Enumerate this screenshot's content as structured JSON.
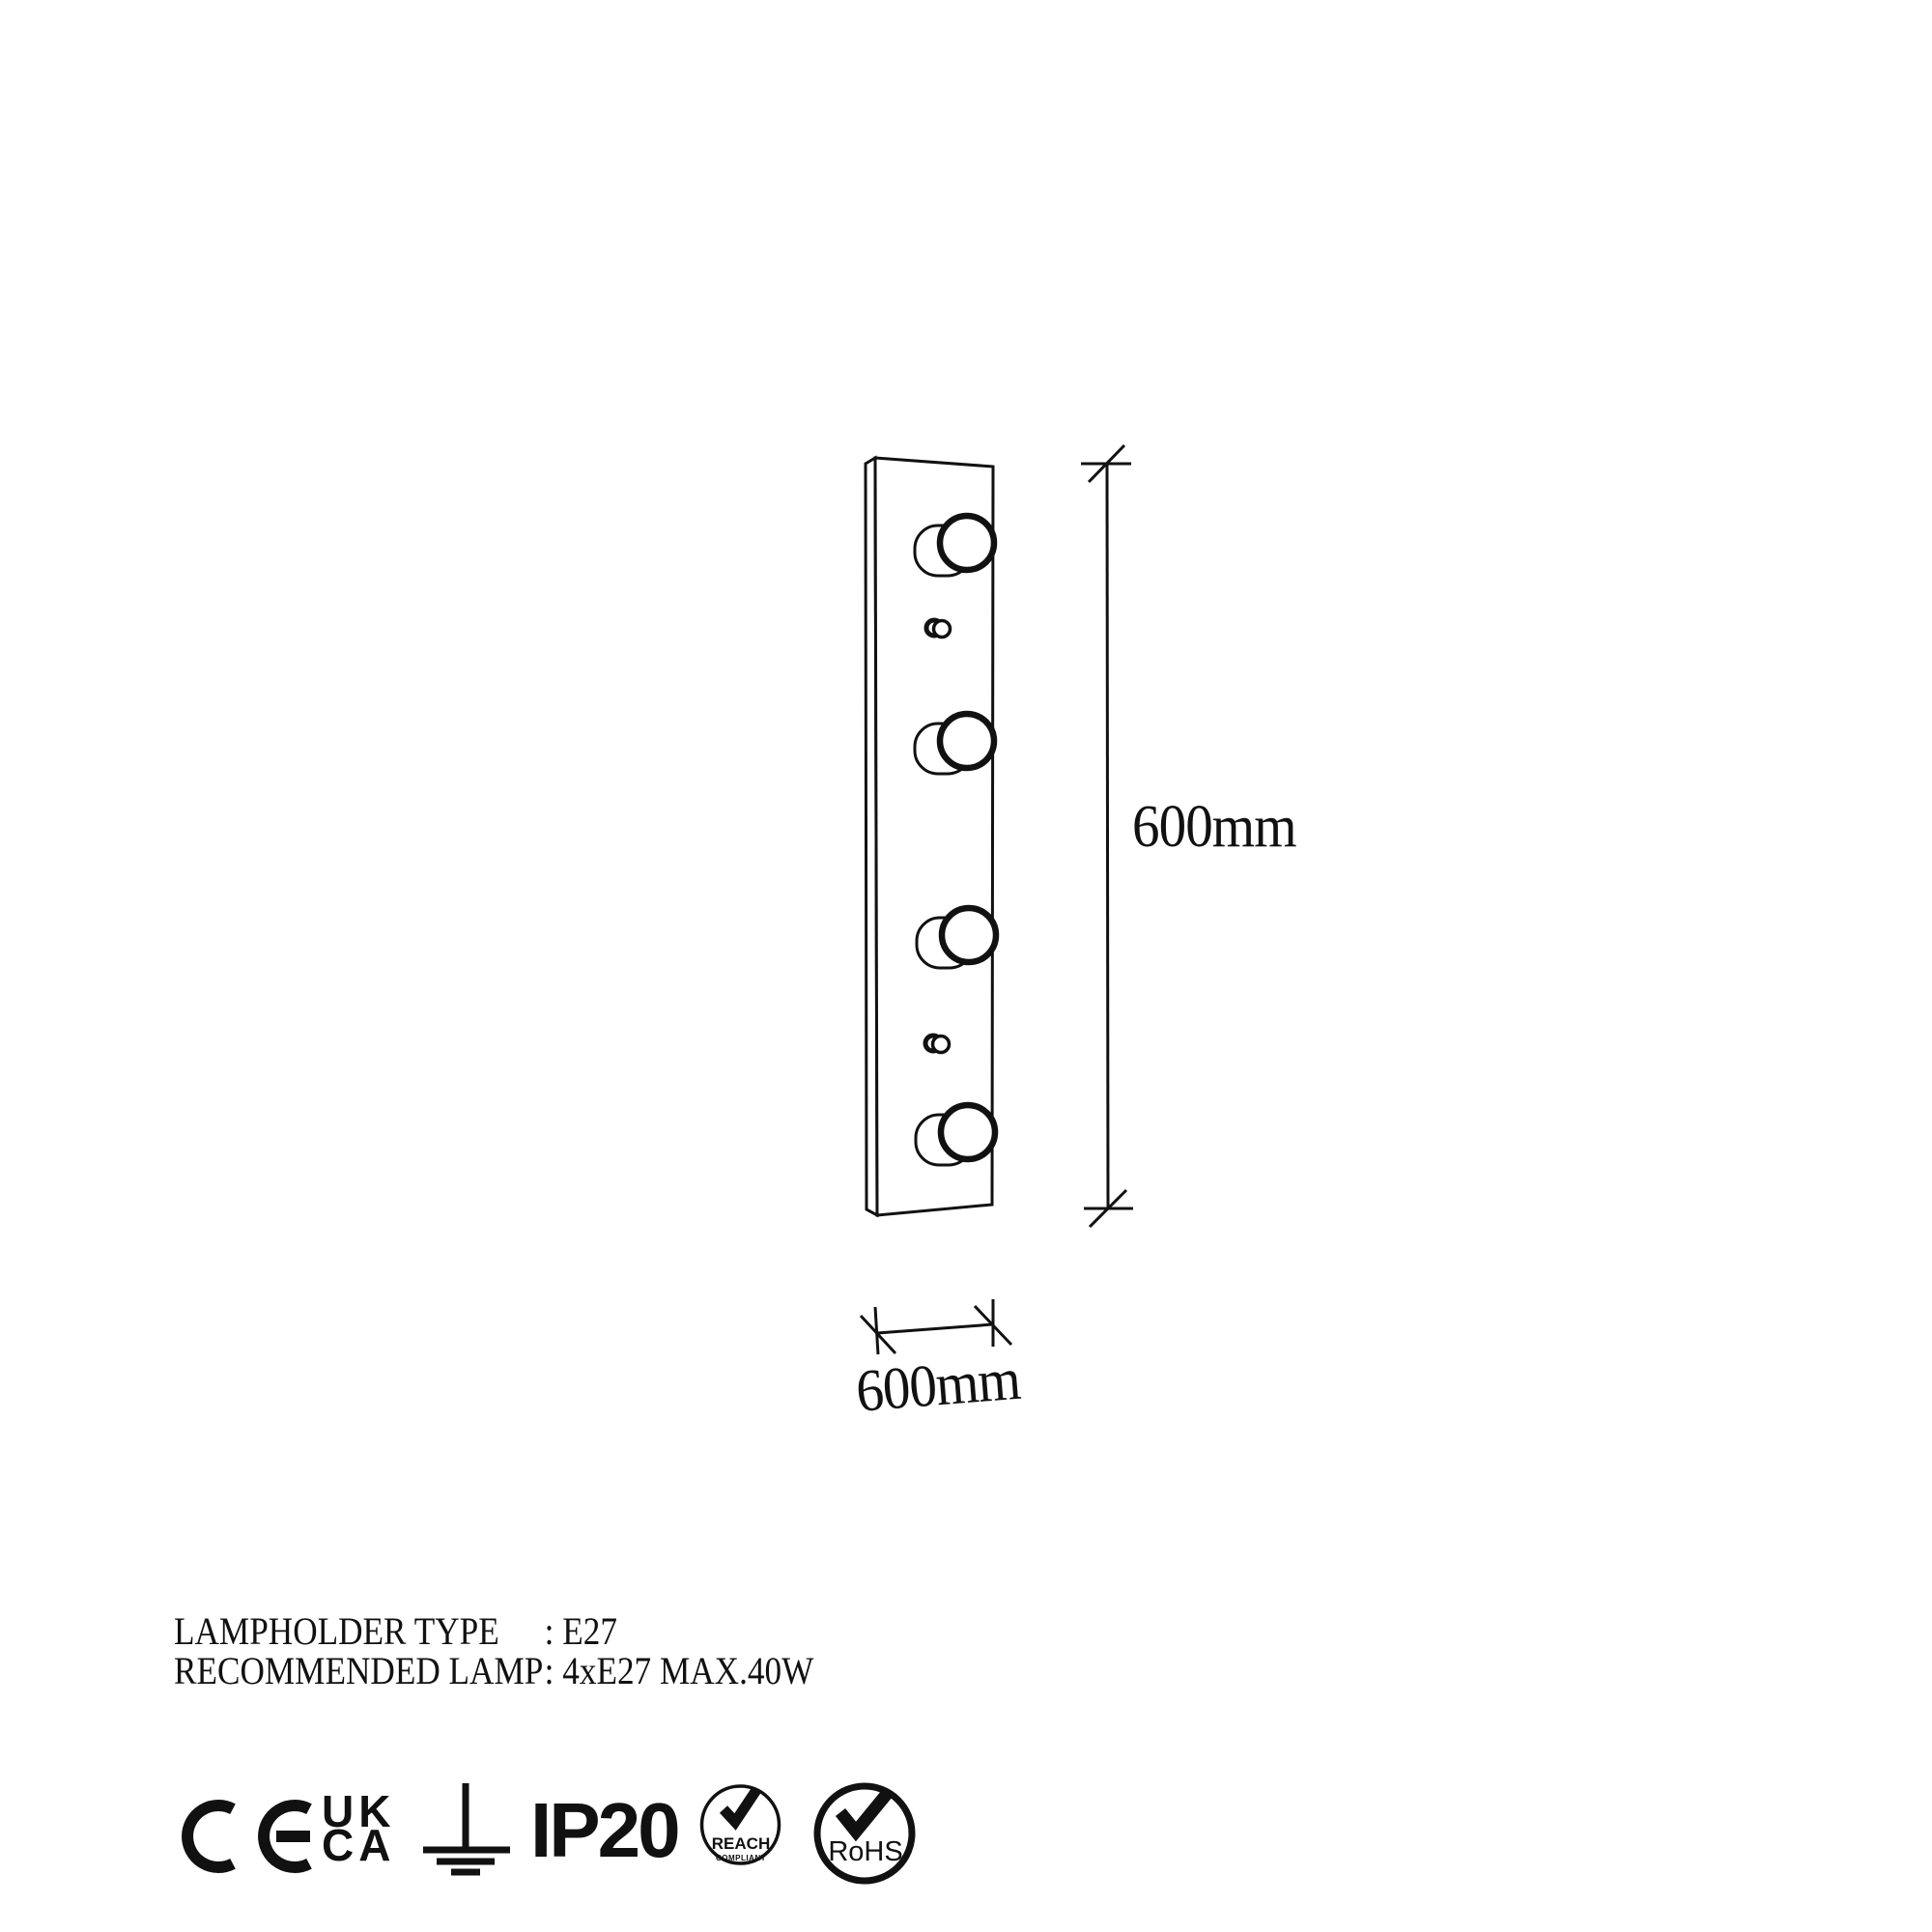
{
  "colors": {
    "ink": "#111111",
    "background": "#ffffff"
  },
  "drawing": {
    "height_dimension": "600mm",
    "width_dimension": "600mm"
  },
  "specs": [
    {
      "label": "LAMPHOLDER TYPE",
      "value": ": E27"
    },
    {
      "label": "RECOMMENDED LAMP",
      "value": ": 4xE27 MAX.40W"
    }
  ],
  "certifications": {
    "ce_icon": "CE",
    "ukca_top": "UK",
    "ukca_bottom": "CA",
    "earth_icon": "earth-ground-symbol",
    "ip_rating": "IP20",
    "reach_label": "REACH",
    "reach_sub": "COMPLIANT",
    "rohs_label": "RoHS"
  }
}
